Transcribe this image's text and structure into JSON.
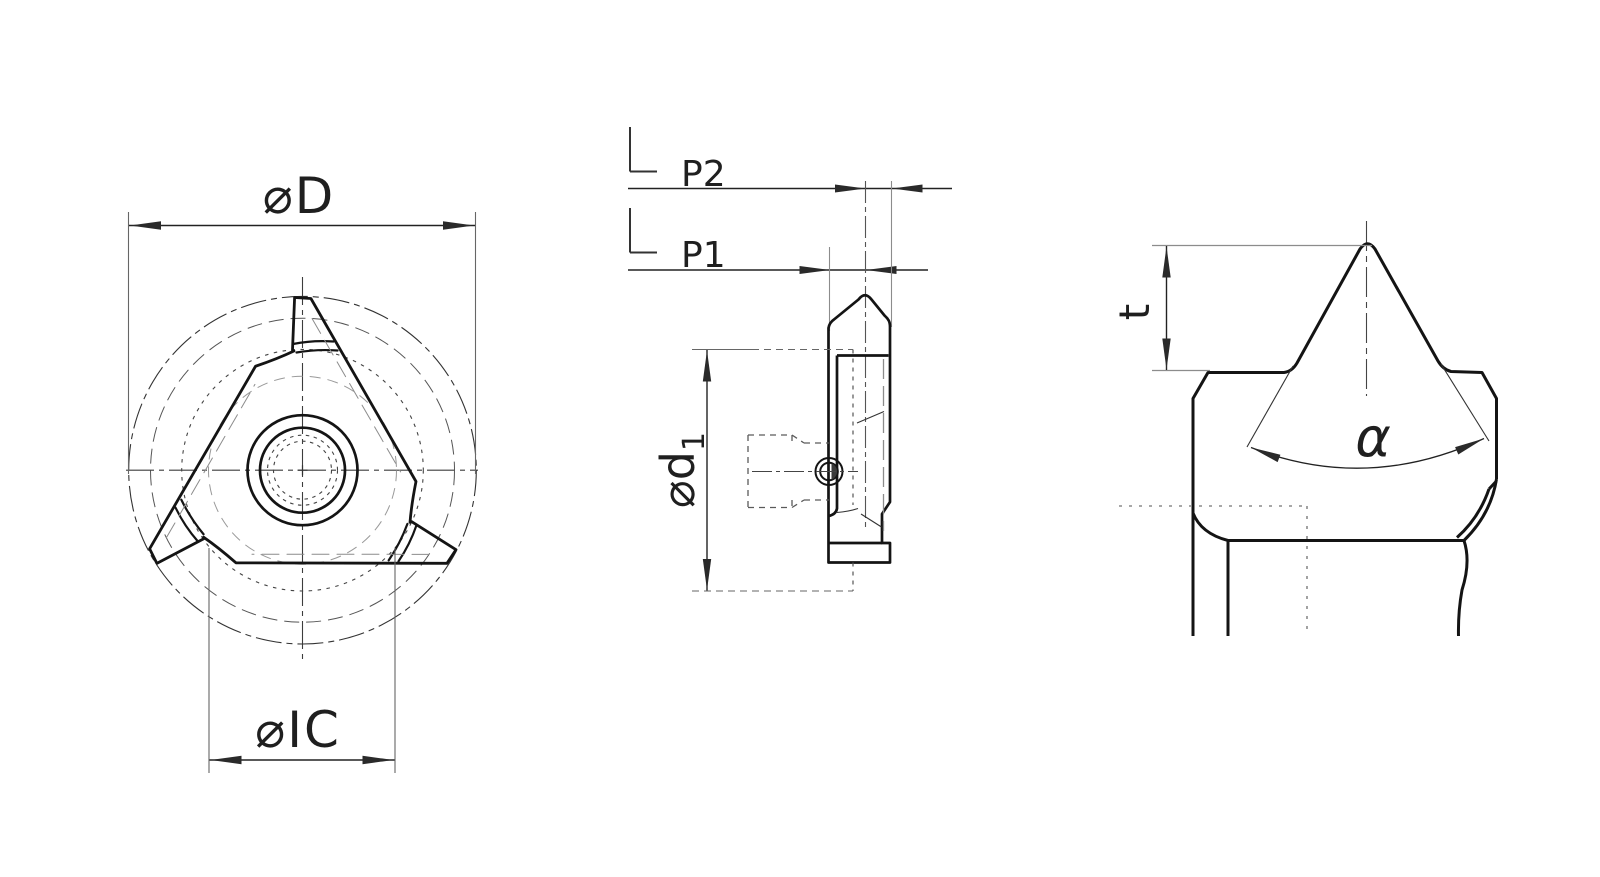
{
  "drawing": {
    "title": "threading-insert-technical-drawing",
    "labels": {
      "d_outer": "⌀D",
      "ic": "⌀IC",
      "p2": "P2",
      "p1": "P1",
      "d1_main": "⌀d",
      "d1_sub": "1",
      "t": "t",
      "alpha": "α"
    },
    "colors": {
      "outline": "#141414",
      "dim": "#2a2a2a",
      "extension": "#8c8c8c",
      "hidden": "#5a5a5a",
      "background": "#ffffff"
    }
  }
}
